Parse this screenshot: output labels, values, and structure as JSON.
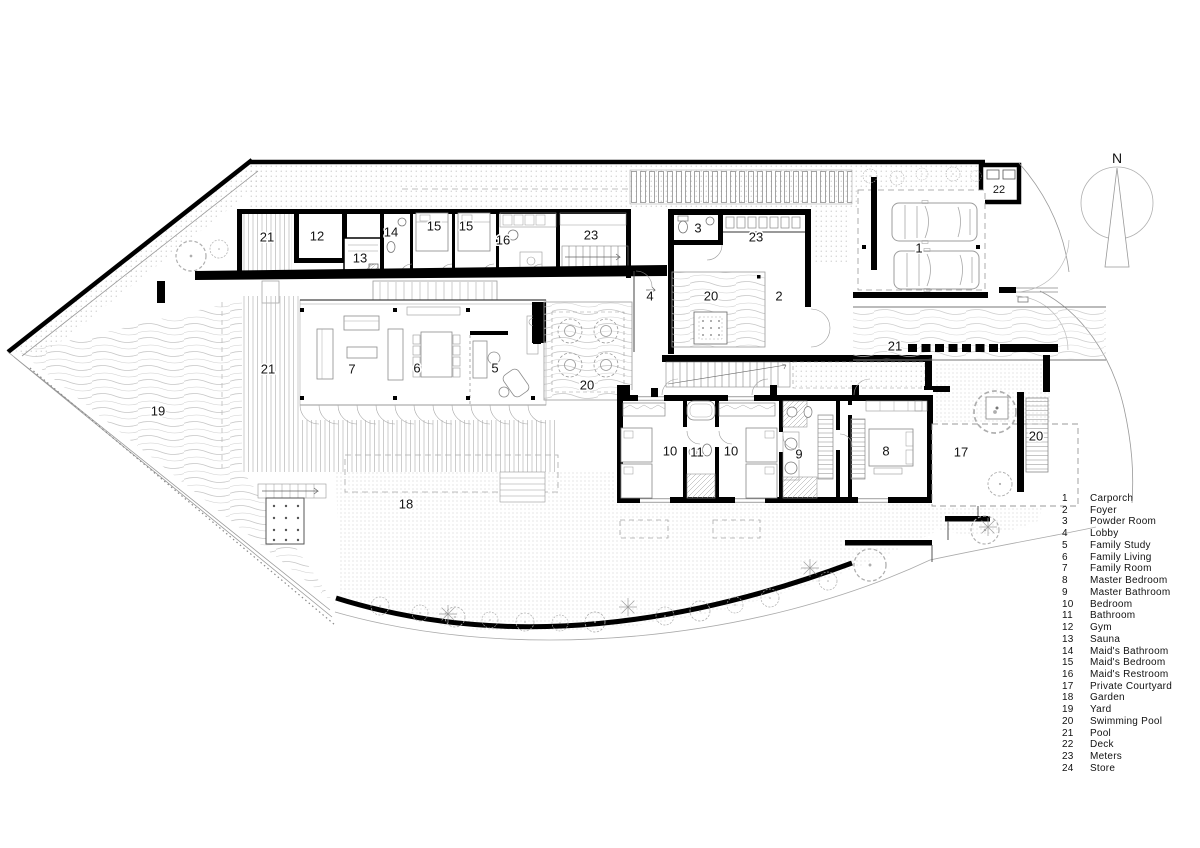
{
  "plan": {
    "north_label": "N",
    "labels": [
      {
        "text": "21"
      },
      {
        "text": "12"
      },
      {
        "text": "13"
      },
      {
        "text": "14"
      },
      {
        "text": "15"
      },
      {
        "text": "15"
      },
      {
        "text": "16"
      },
      {
        "text": "23"
      },
      {
        "text": "3"
      },
      {
        "text": "23"
      },
      {
        "text": "1"
      },
      {
        "text": "22"
      },
      {
        "text": "4"
      },
      {
        "text": "20"
      },
      {
        "text": "2"
      },
      {
        "text": "21"
      },
      {
        "text": "7"
      },
      {
        "text": "6"
      },
      {
        "text": "5"
      },
      {
        "text": "20"
      },
      {
        "text": "21"
      },
      {
        "text": "19"
      },
      {
        "text": "10"
      },
      {
        "text": "11"
      },
      {
        "text": "10"
      },
      {
        "text": "9"
      },
      {
        "text": "8"
      },
      {
        "text": "17"
      },
      {
        "text": "20"
      },
      {
        "text": "18"
      }
    ]
  },
  "legend": {
    "items": [
      {
        "num": "1",
        "label": "Carporch"
      },
      {
        "num": "2",
        "label": "Foyer"
      },
      {
        "num": "3",
        "label": "Powder Room"
      },
      {
        "num": "4",
        "label": "Lobby"
      },
      {
        "num": "5",
        "label": "Family Study"
      },
      {
        "num": "6",
        "label": "Family Living"
      },
      {
        "num": "7",
        "label": "Family Room"
      },
      {
        "num": "8",
        "label": "Master Bedroom"
      },
      {
        "num": "9",
        "label": "Master Bathroom"
      },
      {
        "num": "10",
        "label": "Bedroom"
      },
      {
        "num": "11",
        "label": "Bathroom"
      },
      {
        "num": "12",
        "label": "Gym"
      },
      {
        "num": "13",
        "label": "Sauna"
      },
      {
        "num": "14",
        "label": "Maid's Bathroom"
      },
      {
        "num": "15",
        "label": "Maid's Bedroom"
      },
      {
        "num": "16",
        "label": "Maid's Restroom"
      },
      {
        "num": "17",
        "label": "Private Courtyard"
      },
      {
        "num": "18",
        "label": "Garden"
      },
      {
        "num": "19",
        "label": "Yard"
      },
      {
        "num": "20",
        "label": "Swimming Pool"
      },
      {
        "num": "21",
        "label": "Pool"
      },
      {
        "num": "22",
        "label": "Deck"
      },
      {
        "num": "23",
        "label": "Meters"
      },
      {
        "num": "24",
        "label": "Store"
      }
    ]
  },
  "colors": {
    "ink": "#000000",
    "thin_line": "#9a9a9a",
    "paper": "#ffffff"
  }
}
